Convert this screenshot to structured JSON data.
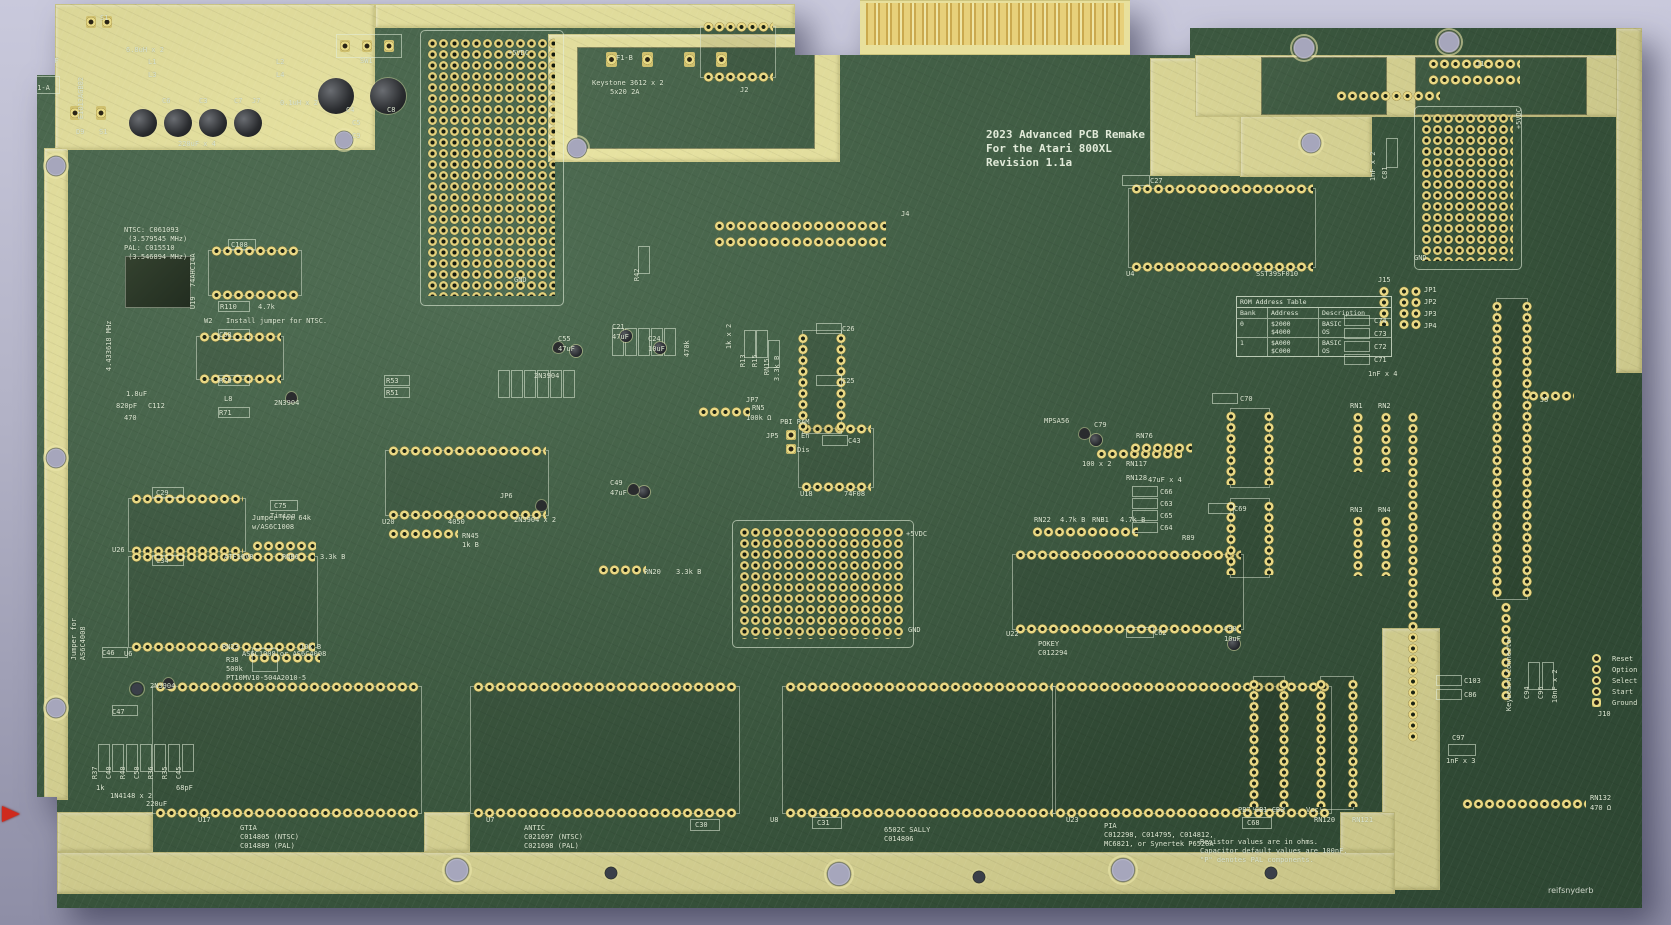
{
  "title_block": {
    "line1": "2023 Advanced PCB Remake",
    "line2": "For the Atari 800XL",
    "line3": "Revision 1.1a"
  },
  "rom_table": {
    "title": "ROM Address Table",
    "headers": [
      "Bank",
      "Address",
      "Description"
    ],
    "rows": [
      {
        "bank": "0",
        "addresses": "$2000\n$4000",
        "descriptions": "BASIC\nOS"
      },
      {
        "bank": "1",
        "addresses": "$A000\n$C000",
        "descriptions": "BASIC\nOS"
      }
    ]
  },
  "signature": "reifsnyderb",
  "colors": {
    "board_green": "#3f5f43",
    "bare_zone_yellow": "#ece7a0",
    "silkscreen": "#dde8d2",
    "pad_gold": "#ead985",
    "finger_gold": "#d8c26a",
    "background_top": "#c9c9dc",
    "background_bottom": "#8e8ea6",
    "red_marker": "#cf2a1d"
  },
  "labels": [
    {
      "t": "S1",
      "x": 100,
      "y": 14
    },
    {
      "t": "1nF",
      "x": 46,
      "y": 57
    },
    {
      "t": "F1-A",
      "x": 33,
      "y": 84
    },
    {
      "t": "EIO13AGB02",
      "x": 86,
      "y": 110,
      "v": 1
    },
    {
      "t": "6.8uH x 2",
      "x": 126,
      "y": 46
    },
    {
      "t": "L1",
      "x": 148,
      "y": 58
    },
    {
      "t": "L3",
      "x": 148,
      "y": 71
    },
    {
      "t": "L2",
      "x": 276,
      "y": 58
    },
    {
      "t": "L4",
      "x": 276,
      "y": 71
    },
    {
      "t": "0.1uH x 2",
      "x": 280,
      "y": 99
    },
    {
      "t": "C6",
      "x": 162,
      "y": 97
    },
    {
      "t": "C3",
      "x": 199,
      "y": 97
    },
    {
      "t": "C7",
      "x": 234,
      "y": 97
    },
    {
      "t": "J7",
      "x": 252,
      "y": 97
    },
    {
      "t": "220uF x 4",
      "x": 178,
      "y": 140
    },
    {
      "t": "D9",
      "x": 76,
      "y": 128
    },
    {
      "t": "S1",
      "x": 99,
      "y": 128
    },
    {
      "t": "SW1",
      "x": 360,
      "y": 57
    },
    {
      "t": "C4",
      "x": 346,
      "y": 106
    },
    {
      "t": "C8",
      "x": 387,
      "y": 106
    },
    {
      "t": "C5",
      "x": 352,
      "y": 119
    },
    {
      "t": "C9",
      "x": 352,
      "y": 132
    },
    {
      "t": "+5VDC",
      "x": 508,
      "y": 49
    },
    {
      "t": "GND",
      "x": 514,
      "y": 276
    },
    {
      "t": "R42",
      "x": 642,
      "y": 272,
      "v": 1
    },
    {
      "t": "F1-B",
      "x": 616,
      "y": 54
    },
    {
      "t": "Keystone 3612 x 2",
      "x": 592,
      "y": 79
    },
    {
      "t": "5x20 2A",
      "x": 610,
      "y": 88
    },
    {
      "t": "J2",
      "x": 740,
      "y": 86
    },
    {
      "t": "1",
      "x": 1132,
      "y": 28
    },
    {
      "t": "J9",
      "x": 1133,
      "y": 40
    },
    {
      "t": "C27",
      "x": 1150,
      "y": 177
    },
    {
      "t": "U4",
      "x": 1126,
      "y": 270
    },
    {
      "t": "SST39SF010",
      "x": 1256,
      "y": 270
    },
    {
      "t": "J4",
      "x": 901,
      "y": 210
    },
    {
      "t": "NTSC: C061093\n (3.579545 MHz)\nPAL: C015510\n (3.546894 MHz)",
      "x": 124,
      "y": 226
    },
    {
      "t": "C108",
      "x": 231,
      "y": 241
    },
    {
      "t": "74AHC14A",
      "x": 198,
      "y": 278,
      "v": 1
    },
    {
      "t": "U19",
      "x": 198,
      "y": 300,
      "v": 1
    },
    {
      "t": "R110",
      "x": 220,
      "y": 303
    },
    {
      "t": "4.7k",
      "x": 258,
      "y": 303
    },
    {
      "t": "W2",
      "x": 204,
      "y": 317
    },
    {
      "t": "Install jumper for NTSC.",
      "x": 226,
      "y": 317
    },
    {
      "t": "4.433618 MHz",
      "x": 114,
      "y": 362,
      "v": 1
    },
    {
      "t": "C58",
      "x": 219,
      "y": 331
    },
    {
      "t": "R70",
      "x": 219,
      "y": 377
    },
    {
      "t": "L8",
      "x": 224,
      "y": 395
    },
    {
      "t": "2N3904",
      "x": 274,
      "y": 399
    },
    {
      "t": "1.8uF",
      "x": 126,
      "y": 390
    },
    {
      "t": "820pF",
      "x": 116,
      "y": 402
    },
    {
      "t": "C112",
      "x": 148,
      "y": 402
    },
    {
      "t": "R71",
      "x": 219,
      "y": 409
    },
    {
      "t": "470",
      "x": 124,
      "y": 414
    },
    {
      "t": "C29",
      "x": 156,
      "y": 489
    },
    {
      "t": "Jumper for 64k\nw/AS6C1008",
      "x": 252,
      "y": 514
    },
    {
      "t": "U26",
      "x": 112,
      "y": 546
    },
    {
      "t": "ATF16V8",
      "x": 224,
      "y": 553
    },
    {
      "t": "RNB6",
      "x": 282,
      "y": 553
    },
    {
      "t": "3.3k B",
      "x": 320,
      "y": 553
    },
    {
      "t": "C75",
      "x": 274,
      "y": 502
    },
    {
      "t": "Timing",
      "x": 270,
      "y": 512
    },
    {
      "t": "C34",
      "x": 156,
      "y": 557
    },
    {
      "t": "Jumper for\nAS6C4008",
      "x": 88,
      "y": 642,
      "v": 1
    },
    {
      "t": "U6",
      "x": 124,
      "y": 650
    },
    {
      "t": "AS6C1008 or AS6C4008",
      "x": 242,
      "y": 650
    },
    {
      "t": "RN23",
      "x": 222,
      "y": 643
    },
    {
      "t": "10k B",
      "x": 300,
      "y": 643
    },
    {
      "t": "R38\n500k\nPT10MV10-504A2010-5",
      "x": 226,
      "y": 656
    },
    {
      "t": "C46",
      "x": 102,
      "y": 649
    },
    {
      "t": "2N3904",
      "x": 150,
      "y": 682
    },
    {
      "t": "C47",
      "x": 112,
      "y": 708
    },
    {
      "t": "R37",
      "x": 100,
      "y": 770,
      "v": 1
    },
    {
      "t": "C40",
      "x": 114,
      "y": 770,
      "v": 1
    },
    {
      "t": "R40",
      "x": 128,
      "y": 770,
      "v": 1
    },
    {
      "t": "C50",
      "x": 142,
      "y": 770,
      "v": 1
    },
    {
      "t": "R36",
      "x": 156,
      "y": 770,
      "v": 1
    },
    {
      "t": "R35",
      "x": 170,
      "y": 770,
      "v": 1
    },
    {
      "t": "C45",
      "x": 184,
      "y": 770,
      "v": 1
    },
    {
      "t": "1k",
      "x": 96,
      "y": 784
    },
    {
      "t": "1N4148 x 2",
      "x": 110,
      "y": 792
    },
    {
      "t": "220uF",
      "x": 146,
      "y": 800
    },
    {
      "t": "68pF",
      "x": 176,
      "y": 784
    },
    {
      "t": "U17",
      "x": 198,
      "y": 816
    },
    {
      "t": "GTIA\nC014805 (NTSC)\nC014889 (PAL)",
      "x": 240,
      "y": 824
    },
    {
      "t": "U7",
      "x": 486,
      "y": 816
    },
    {
      "t": "ANTIC\nC021697 (NTSC)\nC021698 (PAL)",
      "x": 524,
      "y": 824
    },
    {
      "t": "C30",
      "x": 695,
      "y": 821
    },
    {
      "t": "U8",
      "x": 770,
      "y": 816
    },
    {
      "t": "C31",
      "x": 817,
      "y": 819
    },
    {
      "t": "6502C SALLY\nC014806",
      "x": 884,
      "y": 826
    },
    {
      "t": "U23",
      "x": 1066,
      "y": 816
    },
    {
      "t": "PIA\nC012298, C014795, C014812,\nMC6821, or Synertek P6520A",
      "x": 1104,
      "y": 822
    },
    {
      "t": "Resistor values are in ohms.\nCapacitor default values are 100nF.\n\"P\" denotes PAL components.",
      "x": 1200,
      "y": 838
    },
    {
      "t": "C68",
      "x": 1247,
      "y": 819
    },
    {
      "t": "PB7 CB1 CB2",
      "x": 1238,
      "y": 806
    },
    {
      "t": "Vcc",
      "x": 1306,
      "y": 806
    },
    {
      "t": "RN120",
      "x": 1314,
      "y": 816
    },
    {
      "t": "RN121",
      "x": 1352,
      "y": 816
    },
    {
      "t": "RN132",
      "x": 1590,
      "y": 794
    },
    {
      "t": "470 Ω",
      "x": 1590,
      "y": 804
    },
    {
      "t": "C97",
      "x": 1452,
      "y": 734
    },
    {
      "t": "1nF x 3",
      "x": 1446,
      "y": 757
    },
    {
      "t": "C103",
      "x": 1464,
      "y": 677
    },
    {
      "t": "C86",
      "x": 1464,
      "y": 691
    },
    {
      "t": "C94",
      "x": 1532,
      "y": 690,
      "v": 1
    },
    {
      "t": "C96",
      "x": 1546,
      "y": 690,
      "v": 1
    },
    {
      "t": "10nF x 2",
      "x": 1560,
      "y": 694,
      "v": 1
    },
    {
      "t": "Keyboard Connector",
      "x": 1514,
      "y": 702,
      "v": 1
    },
    {
      "t": "Reset",
      "x": 1612,
      "y": 655
    },
    {
      "t": "Option",
      "x": 1612,
      "y": 666
    },
    {
      "t": "Select",
      "x": 1612,
      "y": 677
    },
    {
      "t": "Start",
      "x": 1612,
      "y": 688
    },
    {
      "t": "Ground",
      "x": 1612,
      "y": 699
    },
    {
      "t": "J10",
      "x": 1598,
      "y": 710
    },
    {
      "t": "J1",
      "x": 1476,
      "y": 60
    },
    {
      "t": "+5VDC",
      "x": 1524,
      "y": 120,
      "v": 1
    },
    {
      "t": "C81",
      "x": 1390,
      "y": 170,
      "v": 1
    },
    {
      "t": "1nF x 2",
      "x": 1378,
      "y": 172,
      "v": 1
    },
    {
      "t": "GND",
      "x": 1414,
      "y": 254
    },
    {
      "t": "J15",
      "x": 1378,
      "y": 276
    },
    {
      "t": "JP1",
      "x": 1424,
      "y": 286
    },
    {
      "t": "JP2",
      "x": 1424,
      "y": 298
    },
    {
      "t": "JP3",
      "x": 1424,
      "y": 310
    },
    {
      "t": "JP4",
      "x": 1424,
      "y": 322
    },
    {
      "t": "C74",
      "x": 1374,
      "y": 317
    },
    {
      "t": "C73",
      "x": 1374,
      "y": 330
    },
    {
      "t": "C72",
      "x": 1374,
      "y": 343
    },
    {
      "t": "C71",
      "x": 1374,
      "y": 356
    },
    {
      "t": "1nF x 4",
      "x": 1368,
      "y": 370
    },
    {
      "t": "RN1",
      "x": 1350,
      "y": 402
    },
    {
      "t": "RN2",
      "x": 1378,
      "y": 402
    },
    {
      "t": "J5",
      "x": 1540,
      "y": 396
    },
    {
      "t": "RN3",
      "x": 1350,
      "y": 506
    },
    {
      "t": "RN4",
      "x": 1378,
      "y": 506
    },
    {
      "t": "C70",
      "x": 1240,
      "y": 395
    },
    {
      "t": "RN76",
      "x": 1136,
      "y": 432
    },
    {
      "t": "C79",
      "x": 1094,
      "y": 421
    },
    {
      "t": "MPSA56",
      "x": 1044,
      "y": 417
    },
    {
      "t": "100 x 2",
      "x": 1082,
      "y": 460
    },
    {
      "t": "RN117",
      "x": 1126,
      "y": 460
    },
    {
      "t": "RN128",
      "x": 1126,
      "y": 474
    },
    {
      "t": "47uF x 4",
      "x": 1148,
      "y": 476
    },
    {
      "t": "C66",
      "x": 1160,
      "y": 488
    },
    {
      "t": "C63",
      "x": 1160,
      "y": 500
    },
    {
      "t": "C65",
      "x": 1160,
      "y": 512
    },
    {
      "t": "C64",
      "x": 1160,
      "y": 524
    },
    {
      "t": "RN22",
      "x": 1034,
      "y": 516
    },
    {
      "t": "4.7k B",
      "x": 1060,
      "y": 516
    },
    {
      "t": "RNB1",
      "x": 1092,
      "y": 516
    },
    {
      "t": "4.7k B",
      "x": 1120,
      "y": 516
    },
    {
      "t": "C69",
      "x": 1234,
      "y": 505
    },
    {
      "t": "R89",
      "x": 1182,
      "y": 534
    },
    {
      "t": "U18",
      "x": 800,
      "y": 490
    },
    {
      "t": "74F08",
      "x": 844,
      "y": 490
    },
    {
      "t": "U22",
      "x": 1006,
      "y": 630
    },
    {
      "t": "POKEY\nC012294",
      "x": 1038,
      "y": 640
    },
    {
      "t": "C62",
      "x": 1154,
      "y": 629
    },
    {
      "t": "C98",
      "x": 1224,
      "y": 625
    },
    {
      "t": "10uF",
      "x": 1224,
      "y": 635
    },
    {
      "t": "+5VDC",
      "x": 906,
      "y": 530
    },
    {
      "t": "GND",
      "x": 908,
      "y": 626
    },
    {
      "t": "RN20",
      "x": 644,
      "y": 568
    },
    {
      "t": "3.3k B",
      "x": 676,
      "y": 568
    },
    {
      "t": "RN45",
      "x": 462,
      "y": 532
    },
    {
      "t": "1k B",
      "x": 462,
      "y": 541
    },
    {
      "t": "JP6",
      "x": 500,
      "y": 492
    },
    {
      "t": "2N3904 x 2",
      "x": 514,
      "y": 516
    },
    {
      "t": "C49",
      "x": 610,
      "y": 479
    },
    {
      "t": "47uF",
      "x": 610,
      "y": 489
    },
    {
      "t": "U20",
      "x": 382,
      "y": 518
    },
    {
      "t": "4050",
      "x": 448,
      "y": 518
    },
    {
      "t": "C55",
      "x": 558,
      "y": 335
    },
    {
      "t": "47uF",
      "x": 558,
      "y": 345
    },
    {
      "t": "C21",
      "x": 612,
      "y": 323
    },
    {
      "t": "47uF",
      "x": 612,
      "y": 333
    },
    {
      "t": "C24",
      "x": 648,
      "y": 335
    },
    {
      "t": "10uF",
      "x": 648,
      "y": 345
    },
    {
      "t": "470k",
      "x": 692,
      "y": 348,
      "v": 1
    },
    {
      "t": "1k x 2",
      "x": 734,
      "y": 340,
      "v": 1
    },
    {
      "t": "R13",
      "x": 748,
      "y": 358,
      "v": 1
    },
    {
      "t": "R15",
      "x": 760,
      "y": 358,
      "v": 1
    },
    {
      "t": "RN15",
      "x": 772,
      "y": 366,
      "v": 1
    },
    {
      "t": "3.3k B",
      "x": 782,
      "y": 372,
      "v": 1
    },
    {
      "t": "JP7",
      "x": 746,
      "y": 396
    },
    {
      "t": "2N3904",
      "x": 534,
      "y": 372
    },
    {
      "t": "R53",
      "x": 386,
      "y": 377
    },
    {
      "t": "R51",
      "x": 386,
      "y": 389
    },
    {
      "t": "RN5",
      "x": 752,
      "y": 404
    },
    {
      "t": "100k Ω",
      "x": 746,
      "y": 414
    },
    {
      "t": "PBI RAM",
      "x": 780,
      "y": 418
    },
    {
      "t": "JP5",
      "x": 766,
      "y": 432
    },
    {
      "t": "En",
      "x": 801,
      "y": 432
    },
    {
      "t": "Dis",
      "x": 797,
      "y": 446
    },
    {
      "t": "C26",
      "x": 842,
      "y": 325
    },
    {
      "t": "C25",
      "x": 842,
      "y": 377
    },
    {
      "t": "C43",
      "x": 848,
      "y": 437
    }
  ]
}
